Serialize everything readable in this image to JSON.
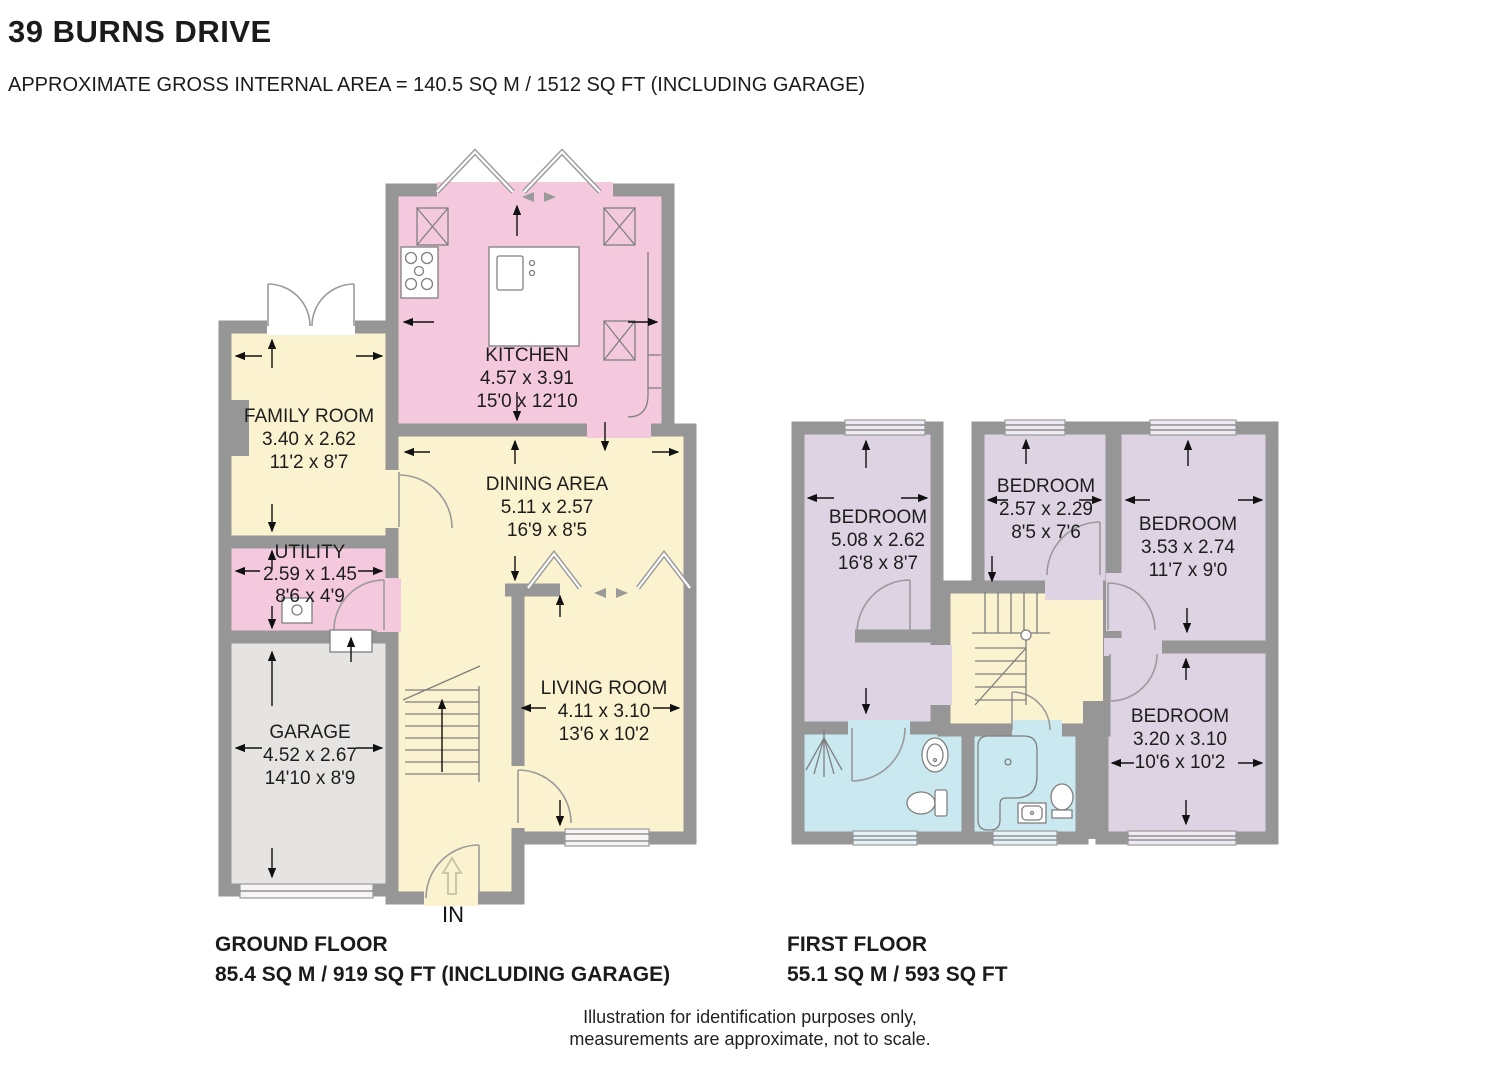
{
  "header": {
    "title": "39 BURNS DRIVE",
    "subtitle": "APPROXIMATE GROSS INTERNAL AREA = 140.5 SQ M / 1512 SQ FT (INCLUDING GARAGE)"
  },
  "ground_floor": {
    "label_line1": "GROUND FLOOR",
    "label_line2": "85.4 SQ M / 919 SQ FT (INCLUDING GARAGE)",
    "entrance_label": "IN",
    "rooms": {
      "kitchen": {
        "name": "KITCHEN",
        "metric": "4.57 x 3.91",
        "imperial": "15'0 x 12'10"
      },
      "family_room": {
        "name": "FAMILY ROOM",
        "metric": "3.40 x 2.62",
        "imperial": "11'2 x 8'7"
      },
      "utility": {
        "name": "UTILITY",
        "metric": "2.59 x 1.45",
        "imperial": "8'6 x 4'9"
      },
      "garage": {
        "name": "GARAGE",
        "metric": "4.52 x 2.67",
        "imperial": "14'10 x 8'9"
      },
      "dining_area": {
        "name": "DINING AREA",
        "metric": "5.11 x 2.57",
        "imperial": "16'9 x 8'5"
      },
      "living_room": {
        "name": "LIVING ROOM",
        "metric": "4.11 x 3.10",
        "imperial": "13'6 x 10'2"
      }
    }
  },
  "first_floor": {
    "label_line1": "FIRST FLOOR",
    "label_line2": "55.1 SQ M / 593 SQ FT",
    "rooms": {
      "bedroom1": {
        "name": "BEDROOM",
        "metric": "5.08 x 2.62",
        "imperial": "16'8 x 8'7"
      },
      "bedroom2": {
        "name": "BEDROOM",
        "metric": "2.57 x 2.29",
        "imperial": "8'5 x 7'6"
      },
      "bedroom3": {
        "name": "BEDROOM",
        "metric": "3.53 x 2.74",
        "imperial": "11'7 x 9'0"
      },
      "bedroom4": {
        "name": "BEDROOM",
        "metric": "3.20 x 3.10",
        "imperial": "10'6 x 10'2"
      }
    }
  },
  "footer": {
    "disclaimer_line1": "Illustration for identification purposes only,",
    "disclaimer_line2": "measurements are approximate, not to scale."
  },
  "colors": {
    "wall": "#969696",
    "kitchen_pink": "#f5c9dd",
    "room_yellow": "#fbf3cf",
    "bedroom_lavender": "#ddd3e3",
    "bathroom_blue": "#c9e8f0",
    "garage_gray": "#e5e4e2",
    "text": "#1b1b1b"
  }
}
